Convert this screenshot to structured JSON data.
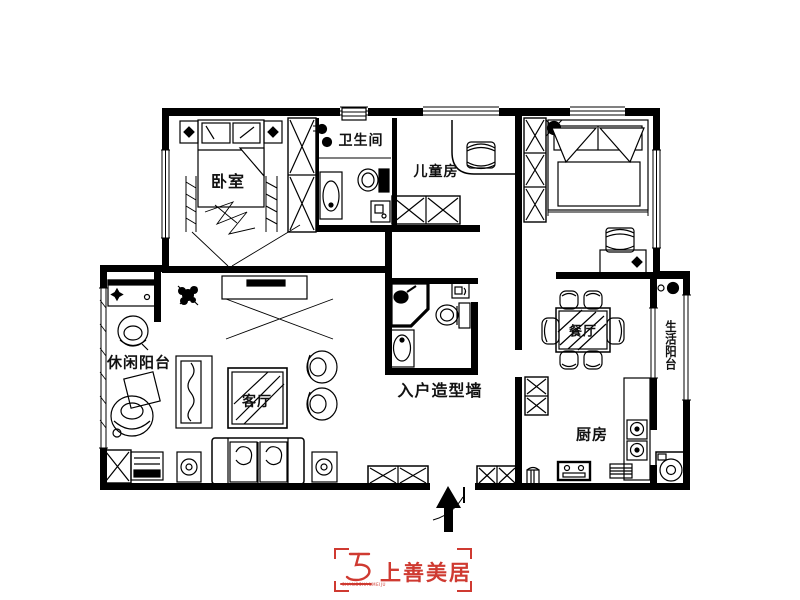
{
  "colors": {
    "background": "#ffffff",
    "line": "#000000",
    "brand_red": "#cf3a31"
  },
  "rooms": [
    {
      "id": "bedroom",
      "label": "卧室"
    },
    {
      "id": "bathroom",
      "label": "卫生间"
    },
    {
      "id": "kids-room",
      "label": "儿童房"
    },
    {
      "id": "leisure-balcony",
      "label": "休闲阳台"
    },
    {
      "id": "living-room",
      "label": "客厅"
    },
    {
      "id": "entry-wall",
      "label": "入户造型墙"
    },
    {
      "id": "dining-room",
      "label": "餐厅"
    },
    {
      "id": "kitchen",
      "label": "厨房"
    },
    {
      "id": "service-balcony",
      "label": "生活阳台"
    }
  ],
  "logo": {
    "title": "上善美居",
    "subtext": "SHANGSHANMEIJU"
  }
}
